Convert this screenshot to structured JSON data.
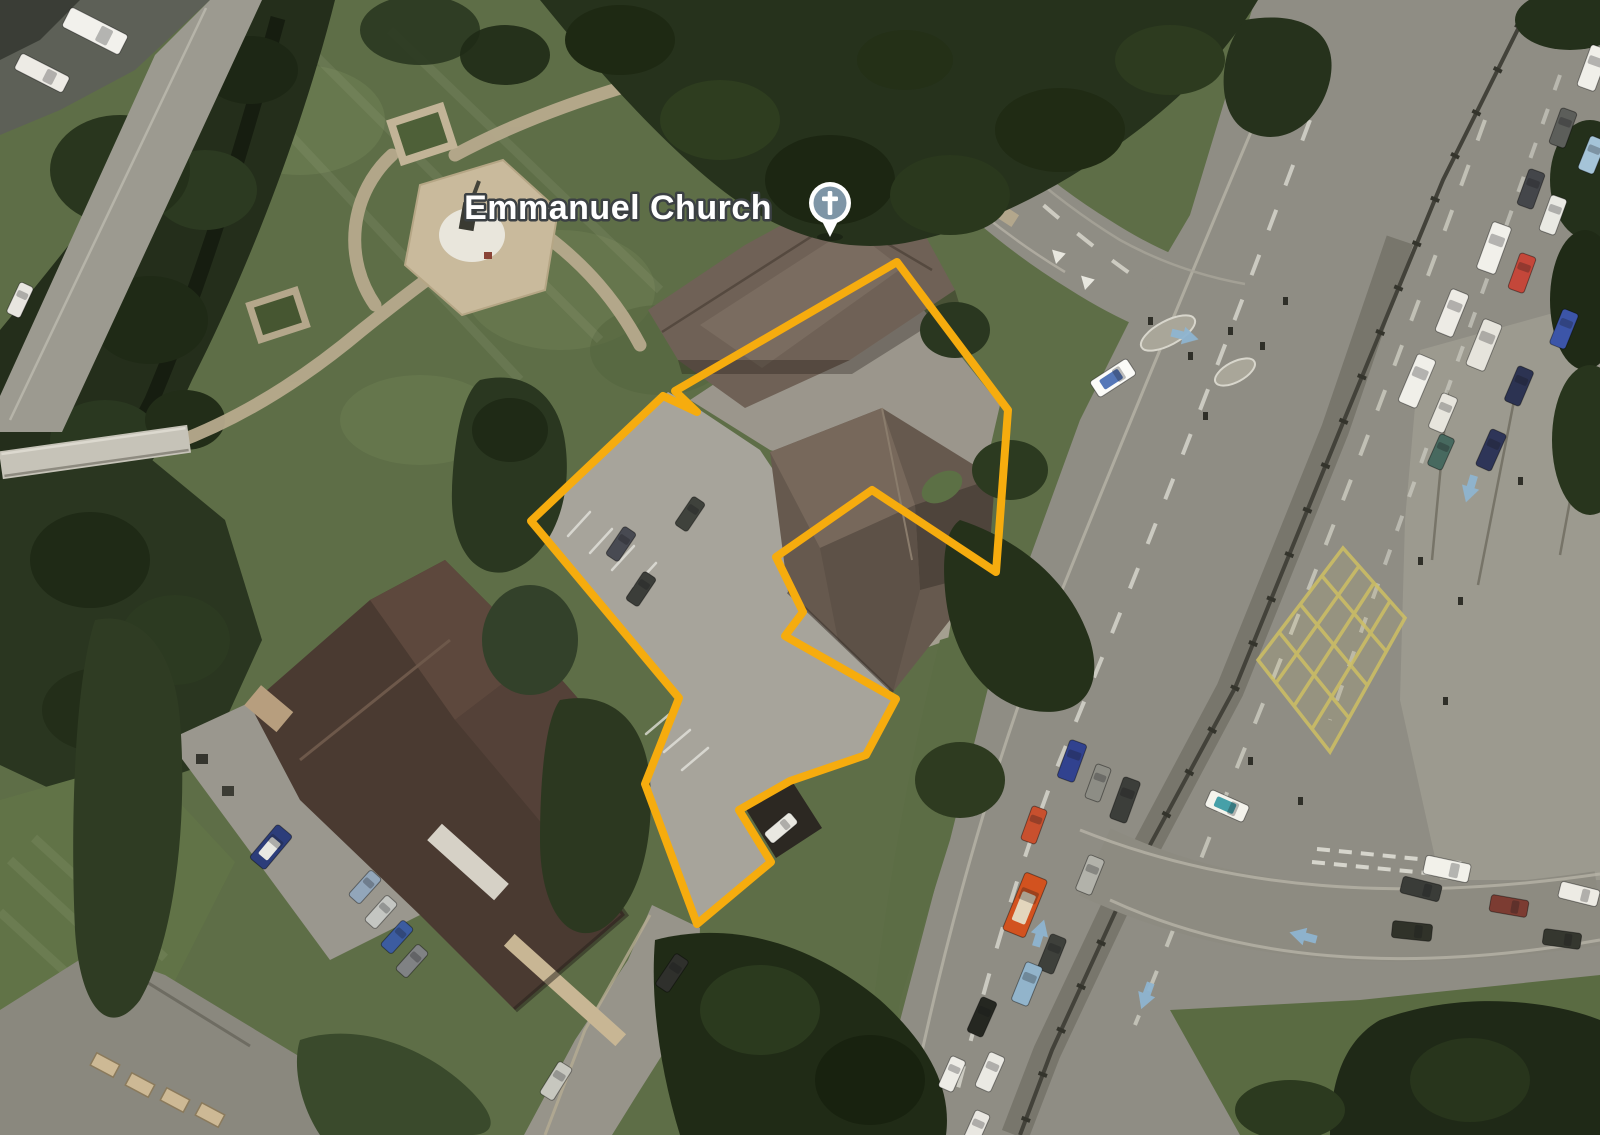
{
  "map": {
    "type": "satellite-view",
    "poi": {
      "label": "Emmanuel Church",
      "label_color": "#ffffff",
      "label_halo": "#3b4043",
      "label_x": 772,
      "label_y": 219,
      "marker": {
        "name": "church-pin",
        "x": 830,
        "y": 203,
        "circle_color": "#7e95a6",
        "ring_color": "#ffffff",
        "glyph": "cross",
        "glyph_color": "#ffffff"
      }
    },
    "boundary": {
      "color": "#f6ac0e",
      "stroke_width": 8,
      "points": "897,262 1008,410 996,572 872,490 776,557 803,612 785,636 896,699 866,755 790,781 739,810 771,862 697,924 645,784 679,698 531,521 663,396 697,412 675,391"
    },
    "palette": {
      "grass": "#5e6e47",
      "grass_light": "#74855a",
      "trees_dark": "#26321c",
      "trees_mid": "#33412a",
      "road": "#8f8d84",
      "road_dark": "#78766c",
      "pavement": "#9c9a8f",
      "path_tan": "#b7aa8d",
      "parking": "#a7a49b",
      "roof_church": "#66594e",
      "roof_north": "#6f6156",
      "roof_court": "#4a3a31",
      "roof_house": "#8a887e",
      "stream_dark": "#141a0e",
      "marking_white": "#e8e7df",
      "box_junction_yellow": "#cfc063",
      "arrow_blue": "#8fb5d0",
      "boundary_yellow": "#f6ac0e",
      "marker_blue_gray": "#7e95a6"
    },
    "vehicles": [
      [
        1593,
        68,
        -70,
        44,
        19,
        "#f0efe9"
      ],
      [
        1563,
        128,
        -70,
        38,
        17,
        "#5c5e5a"
      ],
      [
        1592,
        155,
        -68,
        36,
        17,
        "#a5c4d8"
      ],
      [
        1531,
        189,
        -70,
        38,
        17,
        "#44464a"
      ],
      [
        1553,
        215,
        -70,
        38,
        17,
        "#e9e9e3"
      ],
      [
        1494,
        248,
        -70,
        50,
        20,
        "#f1f0ea"
      ],
      [
        1522,
        273,
        -70,
        38,
        17,
        "#c4473a"
      ],
      [
        1452,
        313,
        -68,
        46,
        19,
        "#edebe5"
      ],
      [
        1484,
        345,
        -68,
        50,
        20,
        "#e6e4dc"
      ],
      [
        1564,
        329,
        -68,
        38,
        17,
        "#3c55a8"
      ],
      [
        1417,
        381,
        -67,
        52,
        20,
        "#f0efe9"
      ],
      [
        1519,
        386,
        -67,
        38,
        17,
        "#2c3352"
      ],
      [
        1443,
        413,
        -67,
        38,
        17,
        "#e7e5dd"
      ],
      [
        1491,
        450,
        -66,
        40,
        17,
        "#2e3558"
      ],
      [
        1441,
        452,
        -66,
        34,
        16,
        "#47695f"
      ],
      [
        1072,
        761,
        -70,
        40,
        18,
        "#31428f"
      ],
      [
        1098,
        783,
        -70,
        36,
        16,
        "#8d8d85"
      ],
      [
        1125,
        800,
        -70,
        44,
        18,
        "#3c3e3a"
      ],
      [
        1034,
        825,
        -70,
        36,
        16,
        "#c8502e"
      ],
      [
        1090,
        875,
        -68,
        38,
        17,
        "#b2b2aa"
      ],
      [
        1025,
        905,
        -68,
        62,
        24,
        "#d2521f",
        "#e3d6bd"
      ],
      [
        1052,
        954,
        -68,
        38,
        17,
        "#3e403b"
      ],
      [
        1027,
        984,
        -68,
        42,
        18,
        "#92b4cb"
      ],
      [
        982,
        1017,
        -66,
        38,
        17,
        "#252721"
      ],
      [
        990,
        1072,
        -66,
        38,
        17,
        "#eae9e3"
      ],
      [
        952,
        1074,
        -66,
        34,
        16,
        "#edece6"
      ],
      [
        976,
        1129,
        -66,
        36,
        16,
        "#e9e7e1"
      ],
      [
        1113,
        378,
        -33,
        44,
        19,
        "#fbfbf8",
        "#5577b8"
      ],
      [
        1447,
        869,
        12,
        46,
        19,
        "#f2f1ea"
      ],
      [
        1421,
        889,
        14,
        40,
        17,
        "#3a3c38"
      ],
      [
        1412,
        931,
        6,
        40,
        17,
        "#303229"
      ],
      [
        1509,
        906,
        10,
        38,
        17,
        "#7c3c32"
      ],
      [
        1579,
        894,
        14,
        40,
        17,
        "#edebe4"
      ],
      [
        1562,
        939,
        8,
        38,
        16,
        "#35372f"
      ],
      [
        1227,
        806,
        24,
        42,
        18,
        "#f4f3ec",
        "#46a0a8"
      ],
      [
        690,
        514,
        -56,
        34,
        15,
        "#3f423c"
      ],
      [
        621,
        544,
        -56,
        34,
        15,
        "#484a52"
      ],
      [
        641,
        589,
        -56,
        34,
        15,
        "#3b3d39"
      ],
      [
        672,
        973,
        -56,
        38,
        16,
        "#2f302c"
      ],
      [
        556,
        1081,
        -58,
        38,
        16,
        "#c7c7bf"
      ],
      [
        781,
        828,
        -40,
        34,
        14,
        "#e9e8e1"
      ],
      [
        271,
        847,
        -50,
        44,
        20,
        "#2c3d7a",
        "#e8e8e2"
      ],
      [
        365,
        887,
        -48,
        34,
        15,
        "#92a6ba"
      ],
      [
        381,
        912,
        -48,
        34,
        15,
        "#c4c6c2"
      ],
      [
        397,
        937,
        -48,
        34,
        15,
        "#3c5ca0"
      ],
      [
        412,
        961,
        -48,
        34,
        15,
        "#808284"
      ],
      [
        95,
        31,
        27,
        64,
        22,
        "#f2f1ec"
      ],
      [
        42,
        73,
        27,
        54,
        18,
        "#edebe5"
      ],
      [
        20,
        300,
        -65,
        34,
        15,
        "#e8e6e0"
      ]
    ],
    "road_arrows": [
      [
        1470,
        489,
        197
      ],
      [
        1146,
        996,
        200
      ],
      [
        1040,
        933,
        17
      ],
      [
        1185,
        336,
        104
      ],
      [
        1303,
        936,
        285
      ]
    ]
  }
}
